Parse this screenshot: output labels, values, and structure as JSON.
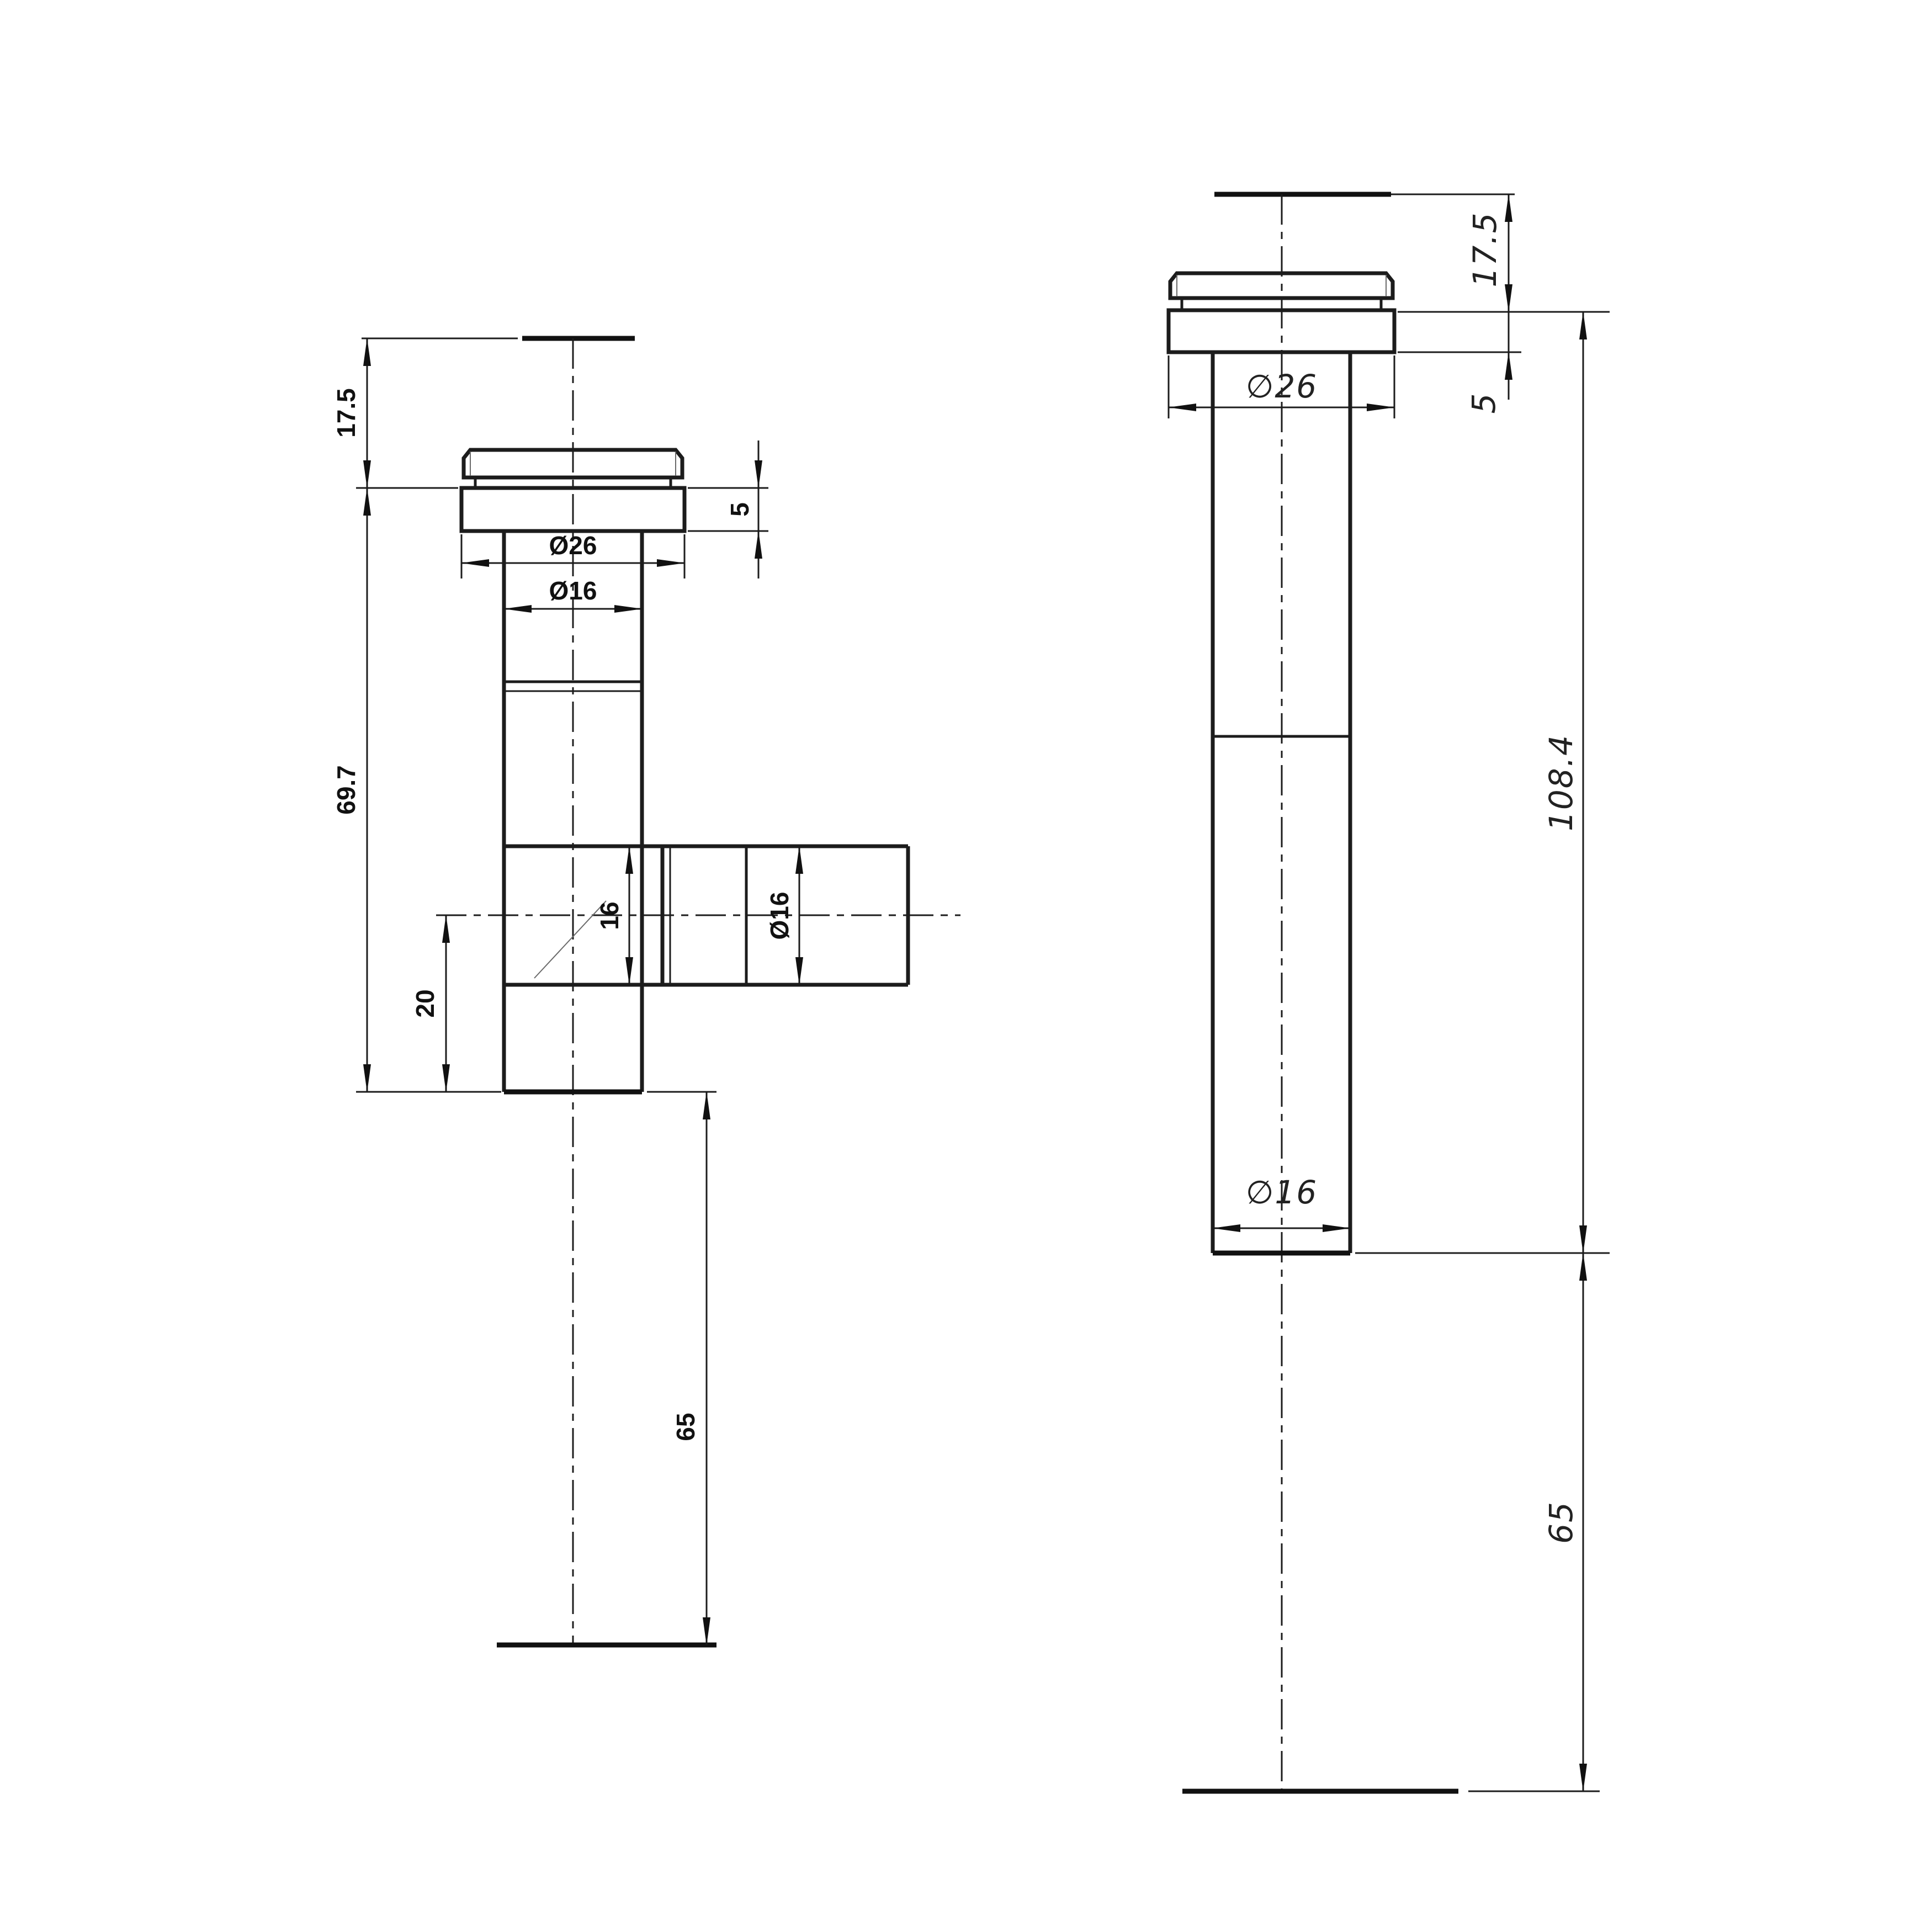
{
  "drawing": {
    "kind": "engineering-dimension-drawing",
    "colors": {
      "background": "#ffffff",
      "line": "#1c1c1c",
      "label": "#111111"
    },
    "left_view": {
      "labels": {
        "cap_height": "17.5",
        "body_length": "69.7",
        "branch_offset": "20",
        "tail_length": "65",
        "flange_thickness": "5",
        "flange_diameter": "Ø26",
        "pipe_diameter": "Ø16",
        "branch_bore": "16",
        "branch_diameter": "Ø16"
      }
    },
    "right_view": {
      "labels": {
        "cap_height": "17.5",
        "flange_thickness": "5",
        "flange_diameter": "∅26",
        "body_length": "108.4",
        "pipe_diameter": "∅16",
        "tail_length": "65"
      }
    }
  }
}
